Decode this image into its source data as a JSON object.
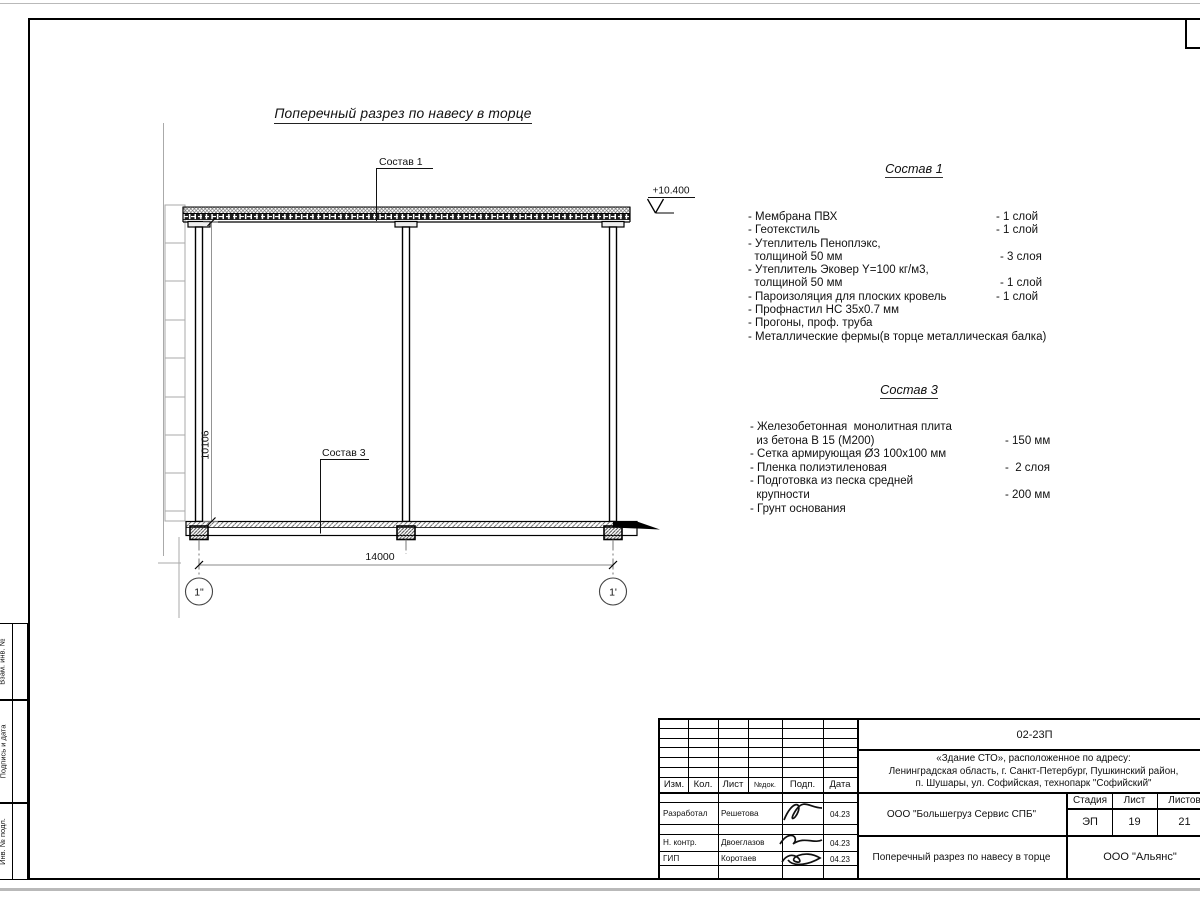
{
  "drawing": {
    "title": "Поперечный разрез по навесу в торце",
    "leader1": "Состав 1",
    "leader3": "Состав 3",
    "elevation_mark": "+10.400",
    "dim_height": "10106",
    "dim_width": "14000",
    "axis_left": "1\"",
    "axis_right": "1'"
  },
  "spec1": {
    "title": "Состав 1",
    "items": [
      {
        "label": "- Мембрана ПВХ",
        "value": "- 1 слой"
      },
      {
        "label": "- Геотекстиль",
        "value": "- 1 слой"
      },
      {
        "label": "- Утеплитель Пеноплэкс,",
        "value": ""
      },
      {
        "label": "  толщиной 50 мм",
        "value": "- 3 слоя"
      },
      {
        "label": "- Утеплитель Эковер Y=100 кг/м3,",
        "value": ""
      },
      {
        "label": "  толщиной 50 мм",
        "value": "- 1 слой"
      },
      {
        "label": "- Пароизоляция для плоских кровель",
        "value": "- 1 слой"
      },
      {
        "label": "- Профнастил НС 35х0.7 мм",
        "value": ""
      },
      {
        "label": "- Прогоны, проф. труба",
        "value": ""
      },
      {
        "label": "- Металлические фермы(в торце металлическая балка)",
        "value": ""
      }
    ]
  },
  "spec3": {
    "title": "Состав 3",
    "items": [
      {
        "label": "- Железобетонная  монолитная плита",
        "value": ""
      },
      {
        "label": "  из бетона В 15 (М200)",
        "value": "- 150 мм"
      },
      {
        "label": "- Сетка армирующая Ø3 100х100 мм",
        "value": ""
      },
      {
        "label": "- Пленка полиэтиленовая",
        "value": "-  2 слоя"
      },
      {
        "label": "- Подготовка из песка средней",
        "value": ""
      },
      {
        "label": "  крупности",
        "value": "- 200 мм"
      },
      {
        "label": "- Грунт основания",
        "value": ""
      }
    ]
  },
  "titleblock": {
    "code": "02-23П",
    "address": [
      "«Здание СТО», расположенное по адресу:",
      "Ленинградская область, г. Санкт-Петербург, Пушкинский район,",
      "п. Шушары, ул. Софийская, технопарк \"Софийский\""
    ],
    "cols": {
      "izm": "Изм.",
      "kol": "Кол.",
      "list": "Лист",
      "ndok": "№док.",
      "podp": "Подп.",
      "data": "Дата"
    },
    "rows": [
      {
        "role": "Разработал",
        "name": "Решетова",
        "date": "04.23"
      },
      {
        "role": "Н. контр.",
        "name": "Двоеглазов",
        "date": "04.23"
      },
      {
        "role": "ГИП",
        "name": "Коротаев",
        "date": "04.23"
      }
    ],
    "org": "ООО \"Большегруз Сервис СПБ\"",
    "doc_title": "Поперечный разрез по навесу в торце",
    "stage_label": "Стадия",
    "sheet_label": "Лист",
    "sheets_label": "Листов",
    "stage": "ЭП",
    "sheet": "19",
    "sheets": "21",
    "firm": "ООО \"Альянс\""
  },
  "margin": {
    "vzam": "Взам. инв. №",
    "podpis": "Подпись и дата",
    "inv": "Инв. № подл."
  }
}
